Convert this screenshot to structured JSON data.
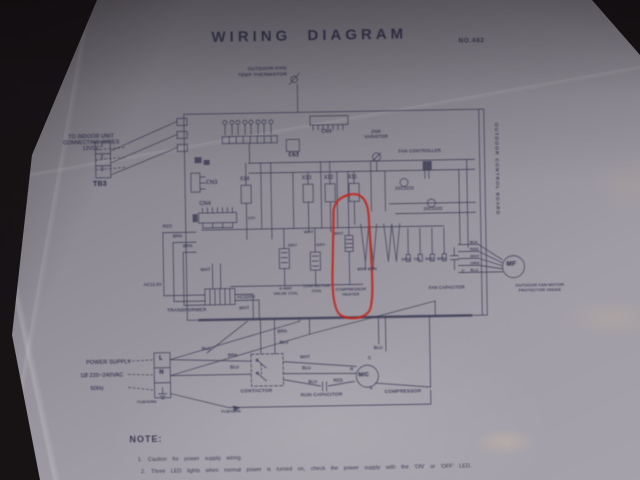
{
  "title": "WIRING DIAGRAM",
  "doc_no": "NO.482",
  "colors": {
    "paper": "#9b97a1",
    "ink": "#3a3a52",
    "annotation_red": "#c1271d",
    "photo_background": "#171315"
  },
  "note": {
    "heading": "NOTE:",
    "lines": [
      "1. Caution for power supply wiring.",
      "2. Three LED lights when normal power is turned on, check the power supply with the 'ON' or 'OFF' LED."
    ]
  },
  "labels": [
    {
      "n": "thermistor-label",
      "t": "OUTDOOR PIPE\nTEMP THERMISTOR",
      "x": 228,
      "y": 66,
      "fs": 4.8,
      "w": 62,
      "ta": "r"
    },
    {
      "n": "indoor-unit-label",
      "t": "TO INDOOR UNIT\nCONNECTING WIRES\n12VDC",
      "x": 56,
      "y": 130,
      "fs": 5.2,
      "w": 74,
      "ta": "c"
    },
    {
      "n": "tb3-label",
      "t": "TB3",
      "x": 94,
      "y": 177,
      "fs": 7,
      "b": 1
    },
    {
      "n": "tb3-terminal-1",
      "t": "1",
      "x": 102,
      "y": 140,
      "fs": 5
    },
    {
      "n": "tb3-terminal-2",
      "t": "2",
      "x": 102,
      "y": 152,
      "fs": 5
    },
    {
      "n": "tb3-terminal-3",
      "t": "3",
      "x": 102,
      "y": 164,
      "fs": 5
    },
    {
      "n": "cn3-label",
      "t": "CN3",
      "x": 207,
      "y": 178,
      "fs": 5.5
    },
    {
      "n": "cn4-left-label",
      "t": "CN4",
      "x": 200,
      "y": 199,
      "fs": 5.5
    },
    {
      "n": "cn2-label",
      "t": "CN2",
      "x": 290,
      "y": 153,
      "fs": 5
    },
    {
      "n": "cn4-top-label",
      "t": "CN4",
      "x": 323,
      "y": 130,
      "fs": 5
    },
    {
      "n": "relay-x14-label",
      "t": "X14",
      "x": 241,
      "y": 176,
      "fs": 5
    },
    {
      "n": "relay-x13-label",
      "t": "X13",
      "x": 303,
      "y": 176,
      "fs": 5
    },
    {
      "n": "relay-x12-label",
      "t": "X12",
      "x": 325,
      "y": 176,
      "fs": 5
    },
    {
      "n": "relay-x11-label",
      "t": "X11",
      "x": 349,
      "y": 176,
      "fs": 5
    },
    {
      "n": "varistor-label",
      "t": "ZNR\nVARISTOR",
      "x": 362,
      "y": 130,
      "fs": 4.4,
      "w": 32,
      "ta": "c"
    },
    {
      "n": "fan-controller-label",
      "t": "FAN CONTROLLER",
      "x": 400,
      "y": 150,
      "fs": 4.4
    },
    {
      "n": "transistor-label-1",
      "t": "2SC2233",
      "x": 396,
      "y": 188,
      "fs": 4.2
    },
    {
      "n": "transistor-label-2",
      "t": "2SC2233",
      "x": 424,
      "y": 209,
      "fs": 4.2
    },
    {
      "n": "relay-coil-12v-label",
      "t": "12V",
      "x": 248,
      "y": 215,
      "fs": 4
    },
    {
      "n": "wire-red-1",
      "t": "RED",
      "x": 163,
      "y": 222,
      "fs": 4.2
    },
    {
      "n": "wire-brn-1",
      "t": "BRN",
      "x": 173,
      "y": 232,
      "fs": 4.2
    },
    {
      "n": "wire-brn-2",
      "t": "BRN",
      "x": 183,
      "y": 242,
      "fs": 4.2
    },
    {
      "n": "wire-wht-1",
      "t": "WHT",
      "x": 200,
      "y": 266,
      "fs": 4.2
    },
    {
      "n": "ac-low-voltage-label",
      "t": "AC12.5V",
      "x": 143,
      "y": 280,
      "fs": 4.2
    },
    {
      "n": "ac220v-label",
      "t": "AC220V",
      "x": 236,
      "y": 293,
      "fs": 4.6
    },
    {
      "n": "transformer-label",
      "t": "TRANSFORMER",
      "x": 166,
      "y": 306,
      "fs": 4.8
    },
    {
      "n": "wire-wht-2",
      "t": "WHT",
      "x": 238,
      "y": 305,
      "fs": 4.2
    },
    {
      "n": "valve-coil-label",
      "t": "4-WAY\nVALVE COIL",
      "x": 268,
      "y": 286,
      "fs": 4,
      "w": 34,
      "ta": "c"
    },
    {
      "n": "contactor-coil-label",
      "t": "CONTACTOR\nCOIL",
      "x": 301,
      "y": 284,
      "fs": 4,
      "w": 30,
      "ta": "c"
    },
    {
      "n": "compressor-heater-label",
      "t": "COMPRESSOR\nHEATER",
      "x": 330,
      "y": 288,
      "fs": 4,
      "w": 40,
      "ta": "c"
    },
    {
      "n": "wire-gry-1",
      "t": "GRY",
      "x": 288,
      "y": 243,
      "fs": 4
    },
    {
      "n": "wire-gry-2",
      "t": "GRY",
      "x": 316,
      "y": 243,
      "fs": 4
    },
    {
      "n": "wire-wht-3",
      "t": "WHT",
      "x": 304,
      "y": 230,
      "fs": 4
    },
    {
      "n": "wire-wht-4",
      "t": "WHT",
      "x": 334,
      "y": 232,
      "fs": 4
    },
    {
      "n": "wire-brn-pair",
      "t": "BRN BRN",
      "x": 357,
      "y": 268,
      "fs": 4
    },
    {
      "n": "pin-orn-label",
      "t": "ORN",
      "x": 401,
      "y": 259,
      "fs": 3.8
    },
    {
      "n": "pin-yel-label",
      "t": "YEL",
      "x": 413,
      "y": 259,
      "fs": 3.8
    },
    {
      "n": "pin-red-label",
      "t": "RED",
      "x": 425,
      "y": 259,
      "fs": 3.8
    },
    {
      "n": "pin-brn-label",
      "t": "BRN",
      "x": 437,
      "y": 259,
      "fs": 3.8
    },
    {
      "n": "motor-wire-blk",
      "t": "BLK",
      "x": 470,
      "y": 243,
      "fs": 3.8
    },
    {
      "n": "motor-wire-red",
      "t": "RED",
      "x": 470,
      "y": 250,
      "fs": 3.8
    },
    {
      "n": "motor-wire-wht",
      "t": "WHT",
      "x": 470,
      "y": 257,
      "fs": 3.8
    },
    {
      "n": "motor-wire-orn",
      "t": "ORN",
      "x": 470,
      "y": 264,
      "fs": 3.8
    },
    {
      "n": "motor-wire-blu",
      "t": "BLU",
      "x": 470,
      "y": 271,
      "fs": 3.8
    },
    {
      "n": "fan-cap-c-label",
      "t": "C",
      "x": 461,
      "y": 271,
      "fs": 4.4
    },
    {
      "n": "fan-capacitor-label",
      "t": "FAN CAPACITOR",
      "x": 428,
      "y": 288,
      "fs": 4.2
    },
    {
      "n": "fan-motor-label",
      "t": "MF",
      "x": 506,
      "y": 264,
      "fs": 6.5,
      "b": 1
    },
    {
      "n": "protector-label",
      "t": "OUTDOOR FAN MOTOR\nPROTECTOR INSIDE",
      "x": 510,
      "y": 287,
      "fs": 4,
      "w": 58,
      "ta": "c"
    },
    {
      "n": "board-label",
      "t": "OUTDOOR CONTROL BOARD",
      "x": 500,
      "y": 126,
      "fs": 4.8,
      "rot": 90,
      "ls": 1.2
    },
    {
      "n": "power-supply-label",
      "t": "POWER SUPPLY",
      "x": 84,
      "y": 356,
      "fs": 5.4
    },
    {
      "n": "voltage-label",
      "t": "1Ø 220~240VAC",
      "x": 78,
      "y": 369,
      "fs": 5.4
    },
    {
      "n": "frequency-label",
      "t": "50Hz",
      "x": 88,
      "y": 382,
      "fs": 5.4
    },
    {
      "n": "terminal-l-label",
      "t": "L",
      "x": 157,
      "y": 353,
      "fs": 6,
      "b": 1
    },
    {
      "n": "terminal-n-label",
      "t": "N",
      "x": 157,
      "y": 367,
      "fs": 6,
      "b": 1
    },
    {
      "n": "wire-ylwgrn-1",
      "t": "YLW/GRN",
      "x": 134,
      "y": 397,
      "fs": 4
    },
    {
      "n": "wire-ylwgrn-2",
      "t": "YLW/GRN",
      "x": 218,
      "y": 408,
      "fs": 4
    },
    {
      "n": "wire-brn-4",
      "t": "BRN",
      "x": 226,
      "y": 352,
      "fs": 4.2
    },
    {
      "n": "wire-blu-1",
      "t": "BLU",
      "x": 228,
      "y": 364,
      "fs": 4.2
    },
    {
      "n": "wire-blu-2",
      "t": "BLU",
      "x": 200,
      "y": 345,
      "fs": 4.2
    },
    {
      "n": "wire-brn-5",
      "t": "BRN",
      "x": 276,
      "y": 329,
      "fs": 4.2
    },
    {
      "n": "wire-blu-3",
      "t": "BLU",
      "x": 278,
      "y": 340,
      "fs": 4.2
    },
    {
      "n": "contactor-label",
      "t": "CONTACTOR",
      "x": 238,
      "y": 388,
      "fs": 4.8
    },
    {
      "n": "wire-wht-5",
      "t": "WHT",
      "x": 298,
      "y": 355,
      "fs": 4.2
    },
    {
      "n": "wire-blu-4",
      "t": "BLU",
      "x": 300,
      "y": 366,
      "fs": 4.2
    },
    {
      "n": "wire-blu-5",
      "t": "BLU",
      "x": 306,
      "y": 380,
      "fs": 4.2
    },
    {
      "n": "wire-red-2",
      "t": "RED",
      "x": 331,
      "y": 379,
      "fs": 4.2
    },
    {
      "n": "run-capacitor-label",
      "t": "RUN CAPACITOR",
      "x": 298,
      "y": 393,
      "fs": 4.8
    },
    {
      "n": "compressor-motor-label",
      "t": "M/C",
      "x": 356,
      "y": 373,
      "fs": 5.5,
      "b": 1
    },
    {
      "n": "compressor-label",
      "t": "COMPRESSOR",
      "x": 382,
      "y": 391,
      "fs": 4.8
    },
    {
      "n": "terminal-c-label",
      "t": "C",
      "x": 366,
      "y": 357,
      "fs": 4.2
    },
    {
      "n": "terminal-r-label",
      "t": "R",
      "x": 348,
      "y": 368,
      "fs": 4.2
    },
    {
      "n": "terminal-s-label",
      "t": "S",
      "x": 367,
      "y": 387,
      "fs": 4.2
    },
    {
      "n": "wire-blu-6",
      "t": "BLU",
      "x": 372,
      "y": 347,
      "fs": 4.2
    }
  ]
}
